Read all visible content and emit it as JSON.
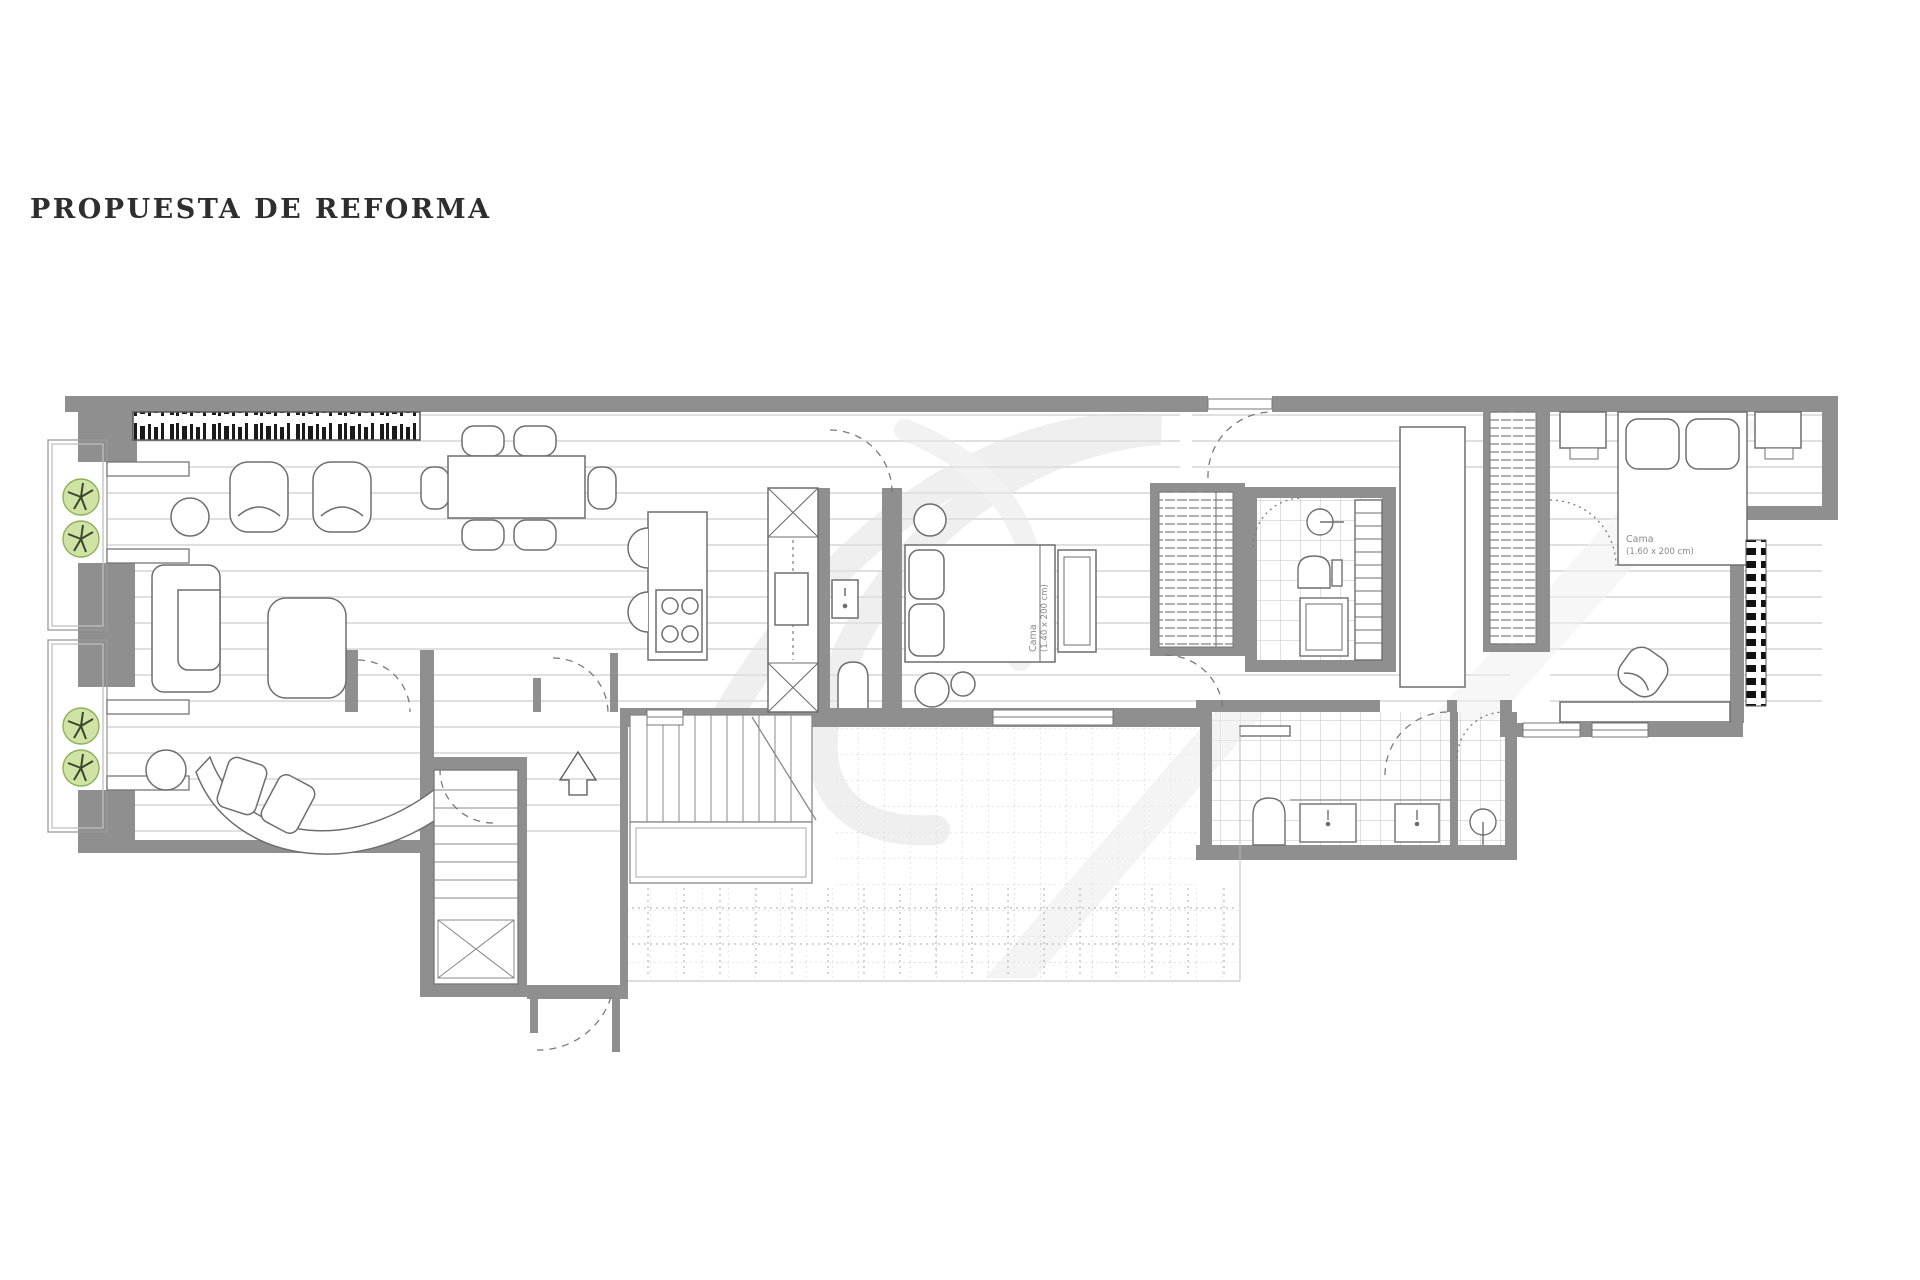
{
  "title": "PROPUESTA DE REFORMA",
  "colors": {
    "background": "#ffffff",
    "wall_gray": "#8f8f8f",
    "furniture_line": "#6e6e6e",
    "floor_line": "#cccccc",
    "tile_line": "#c2c2c2",
    "books_black": "#1a1a1a",
    "plant_fill": "#cfe3a5",
    "plant_stroke": "#8fb05a",
    "watermark_gray": "#e0e0e0",
    "title_color": "#2e2e2e"
  },
  "plan": {
    "rooms": [
      "balcony",
      "living-dining-room",
      "kitchen",
      "entry-hall",
      "stairwell",
      "middle-bedroom",
      "corridor",
      "bathroom-1",
      "dressing-area",
      "bathroom-2",
      "shower-room",
      "master-bedroom"
    ],
    "labels": {
      "middle_bed": {
        "line1": "Cama",
        "line2": "(1.40 x 200 cm)"
      },
      "master_bed": {
        "line1": "Cama",
        "line2": "(1.60 x 200 cm)"
      }
    },
    "furniture": [
      "bookshelf",
      "armchair",
      "armchair",
      "round-side-table",
      "dining-table",
      "dining-chairs",
      "l-shaped-sofa",
      "ottoman",
      "curved-sofa",
      "round-side-table",
      "planter-trees",
      "kitchen-island",
      "cooktop",
      "bar-stools",
      "tall-cabinet-column",
      "wall-appliance",
      "double-bed",
      "bed-bench",
      "wardrobe",
      "toilet",
      "washbasin",
      "shower-tray",
      "towel-ladder",
      "tall-wardrobe",
      "hanging-closet",
      "double-bed",
      "nightstand",
      "nightstand",
      "desk",
      "lounge-chair",
      "radiator",
      "vanity-sinks",
      "toilet",
      "shower-head",
      "staircase",
      "entry-arrow"
    ]
  }
}
